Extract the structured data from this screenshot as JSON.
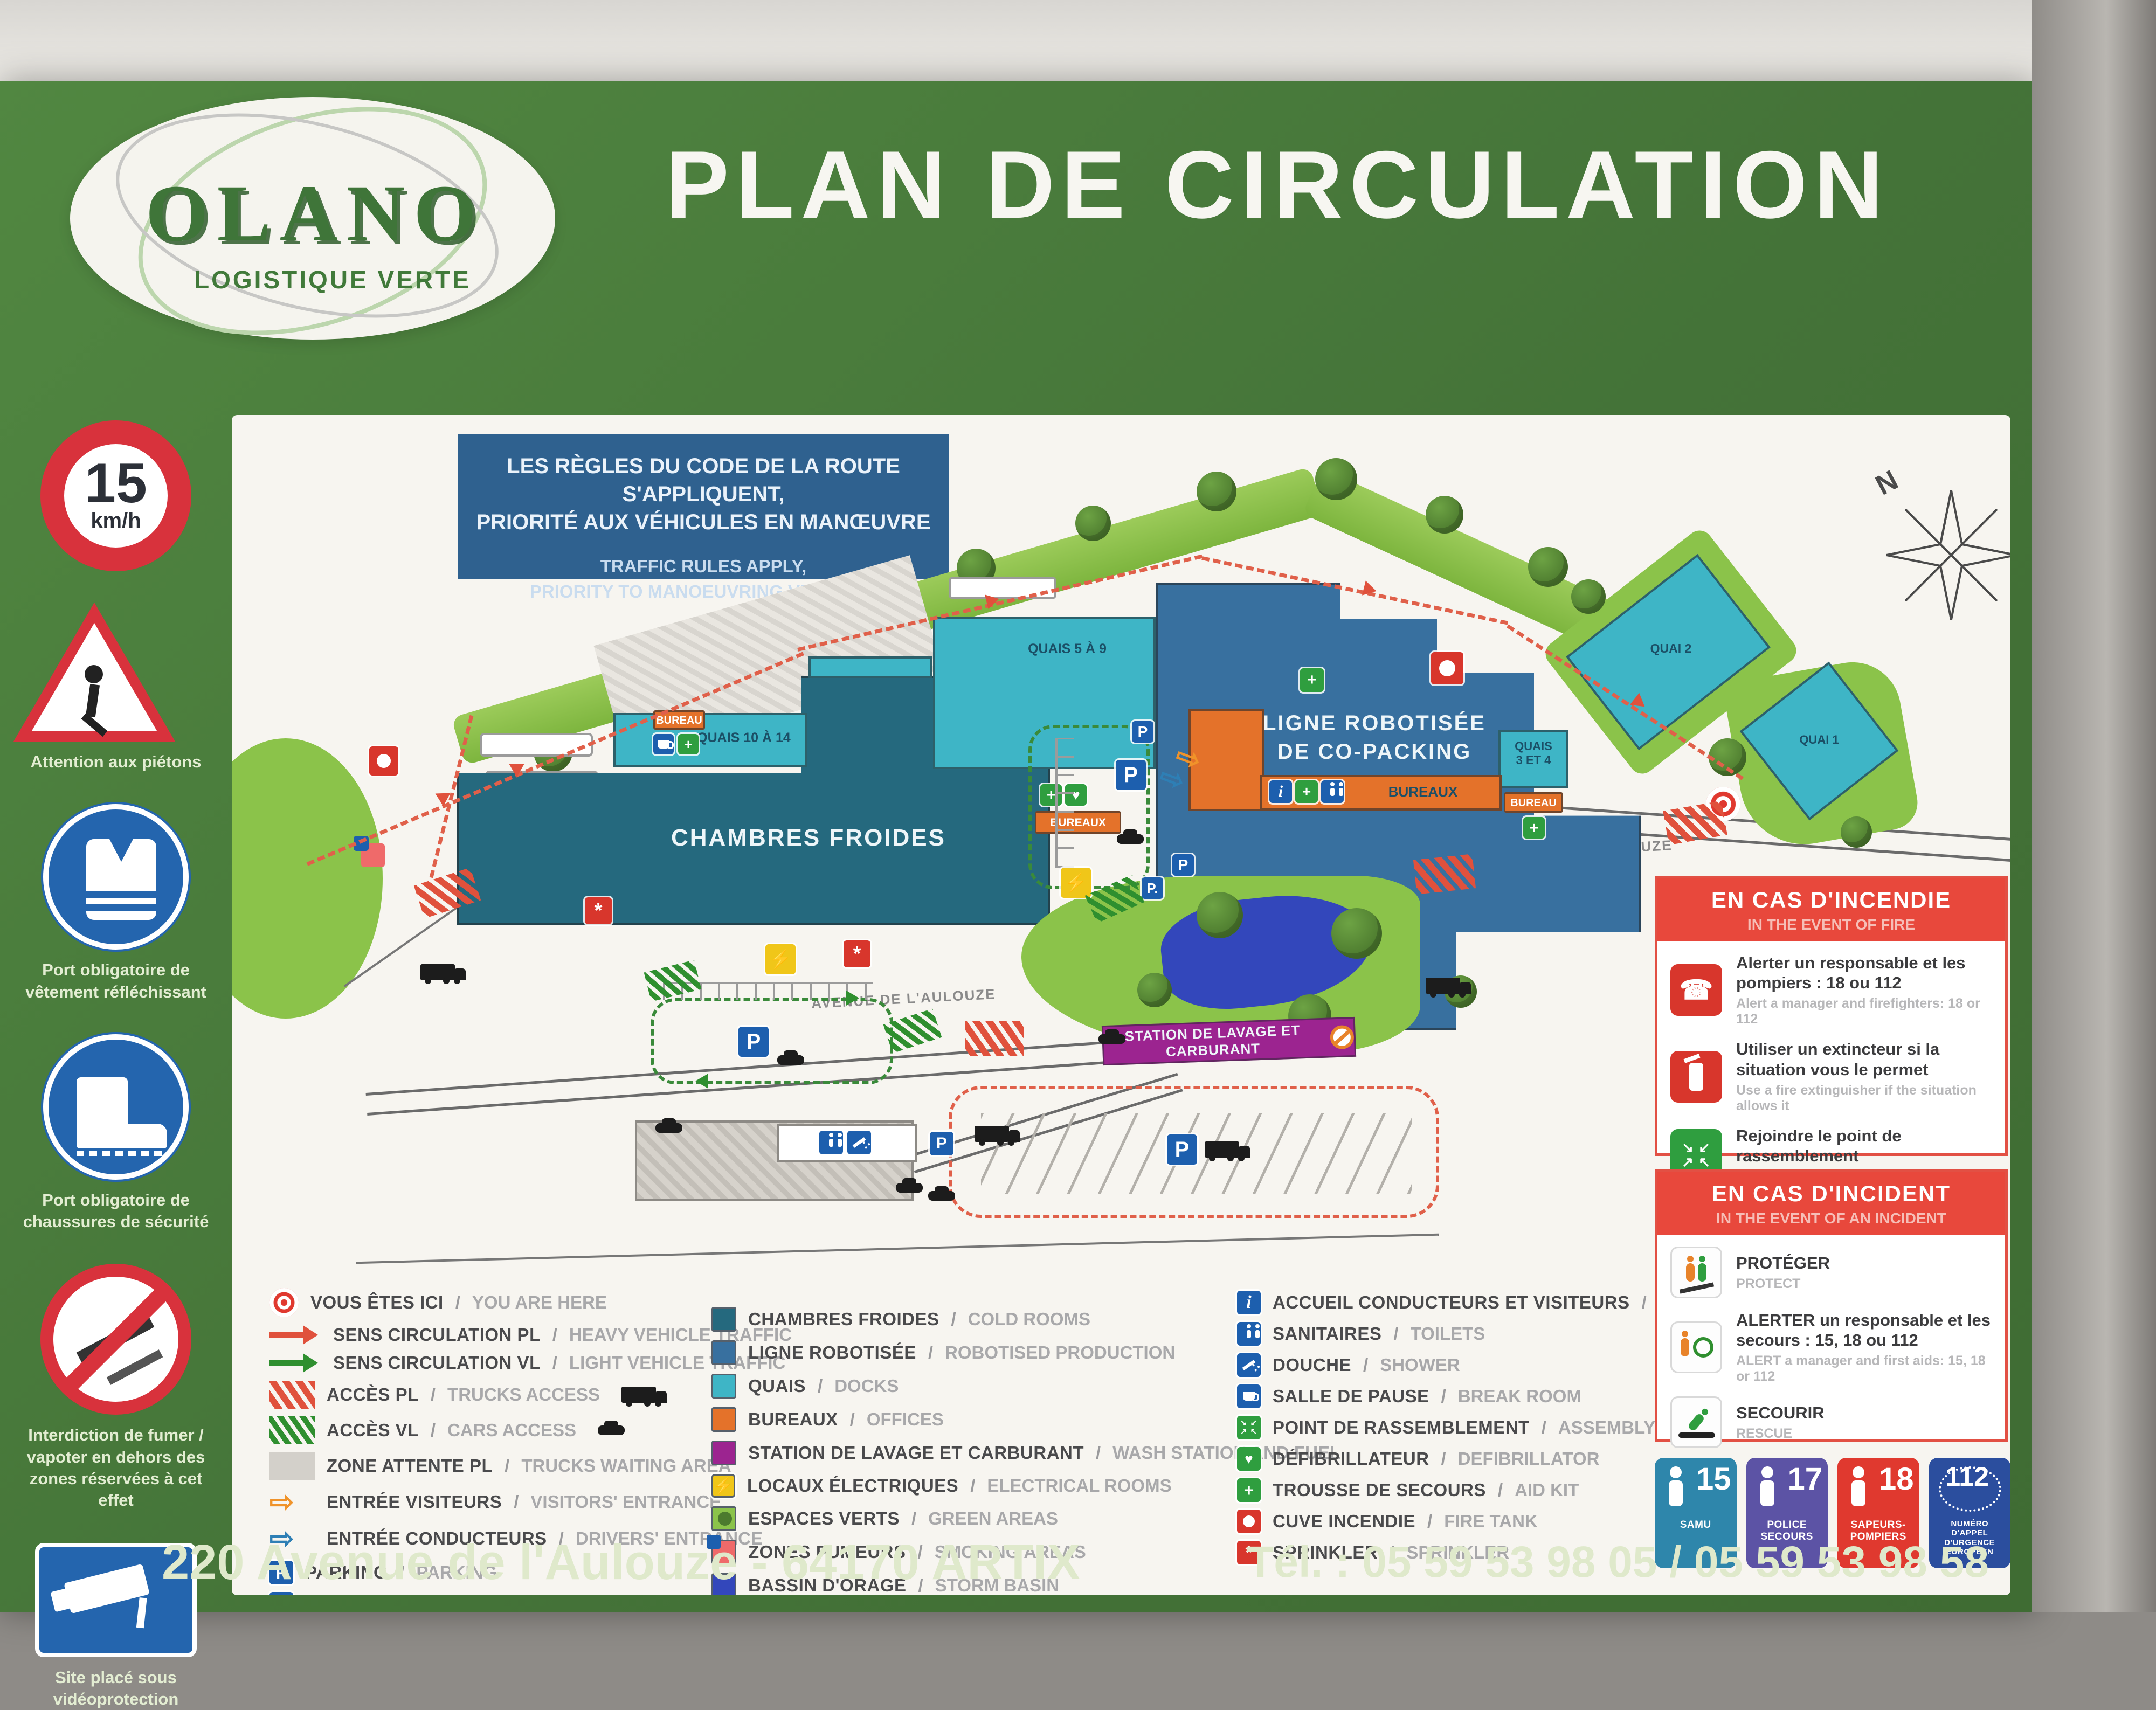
{
  "colors": {
    "green": "#4a7d3c",
    "green_dark": "#3a6a2e",
    "panel": "#f7f5f0",
    "blue_box": "#2f618f",
    "teal_dark": "#25697e",
    "teal_light": "#3eb5c6",
    "blue_mid": "#38709f",
    "orange": "#e4722a",
    "purple": "#9c2490",
    "pond": "#3347bb",
    "green_area": "#8bc34a",
    "red": "#e0392f",
    "yellow": "#f0c619",
    "navy": "#1b4f66"
  },
  "header": {
    "logo_name": "OLANO",
    "logo_tagline": "LOGISTIQUE VERTE",
    "title": "PLAN DE CIRCULATION"
  },
  "sidebar": {
    "speed_value": "15",
    "speed_unit": "km/h",
    "items": [
      {
        "icon": "speed-limit-15-sign",
        "label": ""
      },
      {
        "icon": "pedestrian-warning-sign",
        "label": "Attention aux piétons"
      },
      {
        "icon": "hi-vis-vest-sign",
        "label": "Port obligatoire de vêtement réfléchissant"
      },
      {
        "icon": "safety-boots-sign",
        "label": "Port obligatoire de chaussures de sécurité"
      },
      {
        "icon": "no-smoking-vaping-sign",
        "label": "Interdiction de fumer / vapoter en dehors des zones réservées à cet effet"
      },
      {
        "icon": "cctv-sign",
        "label": "Site placé sous vidéoprotection"
      }
    ]
  },
  "rules_box": {
    "fr1": "LES RÈGLES DU CODE DE LA ROUTE S'APPLIQUENT,",
    "fr2": "PRIORITÉ AUX VÉHICULES EN MANŒUVRE",
    "en1": "TRAFFIC RULES APPLY,",
    "en2": "PRIORITY TO MANOEUVRING VEHICLES"
  },
  "map": {
    "compass": "N",
    "road": "AVENUE DE L'AULOUZE",
    "chambres_froides": "CHAMBRES FROIDES",
    "quais_10_14": "QUAIS 10 À 14",
    "quais_5_9": "QUAIS 5 À 9",
    "ligne1": "LIGNE ROBOTISÉE",
    "ligne2": "DE CO-PACKING",
    "quais34_1": "QUAIS",
    "quais34_2": "3 ET 4",
    "quai2": "QUAI 2",
    "quai1": "QUAI 1",
    "bureau": "BUREAU",
    "bureaux": "BUREAUX",
    "station": "STATION DE LAVAGE ET CARBURANT"
  },
  "legend": {
    "col1": [
      {
        "icon": "you-are-here-icon",
        "fr": "VOUS ÊTES ICI",
        "en": "YOU ARE HERE"
      },
      {
        "icon": "red-arrow-icon",
        "fr": "SENS CIRCULATION PL",
        "en": "HEAVY VEHICLE TRAFFIC"
      },
      {
        "icon": "green-arrow-icon",
        "fr": "SENS CIRCULATION VL",
        "en": "LIGHT VEHICLE TRAFFIC"
      },
      {
        "icon": "red-hatch-truck-icon",
        "fr": "ACCÈS PL",
        "en": "TRUCKS ACCESS"
      },
      {
        "icon": "green-hatch-car-icon",
        "fr": "ACCÈS VL",
        "en": "CARS ACCESS"
      },
      {
        "icon": "grey-zone-icon",
        "fr": "ZONE ATTENTE PL",
        "en": "TRUCKS WAITING AREA"
      },
      {
        "icon": "orange-outline-arrow-icon",
        "fr": "ENTRÉE VISITEURS",
        "en": "VISITORS' ENTRANCE"
      },
      {
        "icon": "blue-outline-arrow-icon",
        "fr": "ENTRÉE CONDUCTEURS",
        "en": "DRIVERS' ENTRANCE"
      },
      {
        "icon": "parking-icon",
        "fr": "PARKING",
        "en": "PARKING"
      },
      {
        "icon": "parking-two-wheels-icon",
        "fr": "PARKING 2 ROUES",
        "en": "TWO-WHEELED PARKING"
      }
    ],
    "col2": [
      {
        "icon": "cold-rooms-swatch",
        "fr": "CHAMBRES FROIDES",
        "en": "COLD ROOMS"
      },
      {
        "icon": "robotised-line-swatch",
        "fr": "LIGNE ROBOTISÉE",
        "en": "ROBOTISED PRODUCTION"
      },
      {
        "icon": "docks-swatch",
        "fr": "QUAIS",
        "en": "DOCKS"
      },
      {
        "icon": "offices-swatch",
        "fr": "BUREAUX",
        "en": "OFFICES"
      },
      {
        "icon": "wash-station-swatch",
        "fr": "STATION DE LAVAGE ET CARBURANT",
        "en": "WASH STATION AND FUEL"
      },
      {
        "icon": "electrical-rooms-icon",
        "fr": "LOCAUX ÉLECTRIQUES",
        "en": "ELECTRICAL ROOMS"
      },
      {
        "icon": "green-areas-icon",
        "fr": "ESPACES VERTS",
        "en": "GREEN AREAS"
      },
      {
        "icon": "smoking-areas-icon",
        "fr": "ZONES FUMEURS",
        "en": "SMOKING AREAS"
      },
      {
        "icon": "storm-basin-swatch",
        "fr": "BASSIN D'ORAGE",
        "en": "STORM BASIN"
      }
    ],
    "col3": [
      {
        "icon": "reception-icon",
        "fr": "ACCUEIL CONDUCTEURS ET VISITEURS",
        "en": "RECEPTION"
      },
      {
        "icon": "toilets-icon",
        "fr": "SANITAIRES",
        "en": "TOILETS"
      },
      {
        "icon": "shower-icon",
        "fr": "DOUCHE",
        "en": "SHOWER"
      },
      {
        "icon": "break-room-icon",
        "fr": "SALLE DE PAUSE",
        "en": "BREAK ROOM"
      },
      {
        "icon": "assembly-point-icon",
        "fr": "POINT DE RASSEMBLEMENT",
        "en": "ASSEMBLY POINT"
      },
      {
        "icon": "defibrillator-icon",
        "fr": "DÉFIBRILLATEUR",
        "en": "DEFIBRILLATOR"
      },
      {
        "icon": "first-aid-kit-icon",
        "fr": "TROUSSE DE SECOURS",
        "en": "AID KIT"
      },
      {
        "icon": "fire-tank-icon",
        "fr": "CUVE INCENDIE",
        "en": "FIRE TANK"
      },
      {
        "icon": "sprinkler-icon",
        "fr": "SPRINKLER",
        "en": "SPRINKLER"
      }
    ]
  },
  "fire_box": {
    "title_fr": "EN CAS D'INCENDIE",
    "title_en": "IN THE EVENT OF FIRE",
    "items": [
      {
        "icon": "fire-phone-icon",
        "fr": "Alerter un responsable et les pompiers : 18 ou 112",
        "en": "Alert a manager and firefighters: 18 or 112"
      },
      {
        "icon": "fire-extinguisher-icon",
        "fr": "Utiliser un extincteur si la situation vous le permet",
        "en": "Use a fire extinguisher if the situation allows it"
      },
      {
        "icon": "assembly-point-icon",
        "fr": "Rejoindre le point de rassemblement",
        "en": "Meet at the assembly point"
      }
    ]
  },
  "incident_box": {
    "title_fr": "EN CAS D'INCIDENT",
    "title_en": "IN THE EVENT OF AN INCIDENT",
    "items": [
      {
        "icon": "protect-icon",
        "fr": "PROTÉGER",
        "en": "PROTECT"
      },
      {
        "icon": "alert-icon",
        "fr": "ALERTER un responsable et les secours : 15, 18 ou 112",
        "en": "ALERT a manager and first aids: 15, 18 or 112"
      },
      {
        "icon": "rescue-icon",
        "fr": "SECOURIR",
        "en": "RESCUE"
      }
    ]
  },
  "emergency_numbers": [
    {
      "number": "15",
      "label": "SAMU",
      "color": "#2e86ab"
    },
    {
      "number": "17",
      "label": "POLICE SECOURS",
      "color": "#5c53a5"
    },
    {
      "number": "18",
      "label": "SAPEURS-POMPIERS",
      "color": "#e0392f"
    },
    {
      "number": "112",
      "label": "NUMÉRO D'APPEL D'URGENCE EUROPÉEN",
      "color": "#2b4e9e"
    }
  ],
  "footer": {
    "address": "220 Avenue de l'Aulouze - 64170 ARTIX",
    "phone": "Tél. : 05 59 53 98 05 / 05 59 53 98 58"
  }
}
